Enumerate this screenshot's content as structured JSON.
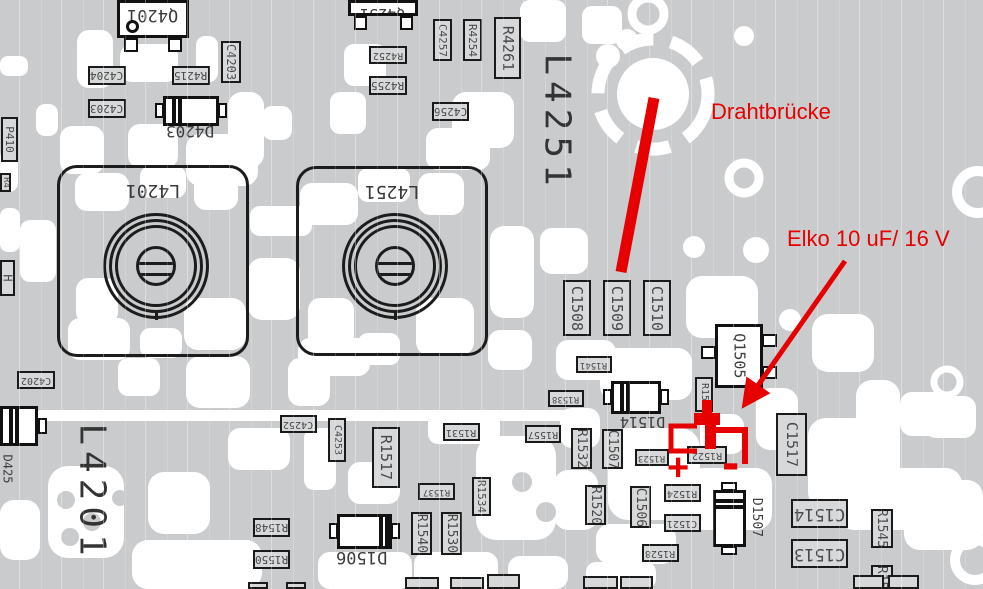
{
  "colors": {
    "board_bg": "#c9cbcd",
    "trace_white": "#ffffff",
    "component_fill": "#d7d8d9",
    "component_border": "#1a1a1a",
    "label_text": "#484848",
    "big_text": "#333333",
    "annotation_red": "#e60000"
  },
  "annotations": {
    "wire_bridge": {
      "text": "Drahtbrücke",
      "x": 711,
      "y": 99
    },
    "elko": {
      "text": "Elko 10 uF/ 16 V",
      "x": 787,
      "y": 226
    },
    "plus_sign": "+",
    "minus_sign": "-"
  },
  "big_texts": [
    {
      "text": "L4251",
      "x": 535,
      "y": 42,
      "w": 44,
      "h": 160,
      "fs": 36
    },
    {
      "text": "L4201",
      "x": 70,
      "y": 414,
      "w": 44,
      "h": 156,
      "fs": 36
    }
  ],
  "coils": [
    {
      "label": "L4201",
      "x": 57,
      "y": 165,
      "w": 192,
      "h": 192
    },
    {
      "label": "L4251",
      "x": 296,
      "y": 166,
      "w": 192,
      "h": 190
    }
  ],
  "transistors": [
    {
      "label": "Q4201",
      "x": 117,
      "y": 0,
      "w": 72,
      "h": 38,
      "rot": 180,
      "fs": 17,
      "legs": [
        [
          124,
          38,
          14,
          14
        ],
        [
          168,
          38,
          14,
          14
        ]
      ],
      "dot": [
        126,
        20,
        13
      ]
    },
    {
      "label": "Q4251",
      "x": 348,
      "y": 0,
      "w": 70,
      "h": 16,
      "rot": 180,
      "fs": 15,
      "legs": [
        [
          354,
          16,
          13,
          14
        ],
        [
          400,
          16,
          13,
          14
        ]
      ]
    },
    {
      "label": "Q1505",
      "x": 715,
      "y": 324,
      "w": 48,
      "h": 64,
      "rot": 90,
      "fs": 15,
      "legs": [
        [
          701,
          346,
          15,
          13
        ],
        [
          762,
          334,
          15,
          13
        ],
        [
          762,
          366,
          15,
          13
        ]
      ]
    }
  ],
  "diodes": [
    {
      "label": "D4203",
      "x": 163,
      "y": 96,
      "w": 56,
      "h": 30,
      "stripes": "left",
      "tabs": [
        [
          155,
          103,
          9,
          15
        ],
        [
          218,
          103,
          9,
          15
        ]
      ],
      "label_box": [
        158,
        121,
        64,
        20
      ],
      "rot": 180,
      "fs": 16
    },
    {
      "label": "D1514",
      "x": 611,
      "y": 381,
      "w": 50,
      "h": 33,
      "stripes": "left",
      "tabs": [
        [
          603,
          389,
          9,
          16
        ],
        [
          660,
          389,
          9,
          16
        ]
      ],
      "label_box": [
        615,
        412,
        56,
        18
      ],
      "rot": 180,
      "fs": 15
    },
    {
      "label": "D1506",
      "x": 337,
      "y": 514,
      "w": 55,
      "h": 35,
      "stripes": "right",
      "tabs": [
        [
          329,
          523,
          9,
          16
        ],
        [
          391,
          523,
          9,
          16
        ]
      ],
      "label_box": [
        330,
        545,
        64,
        22
      ],
      "rot": 180,
      "fs": 17
    },
    {
      "label": "D1507",
      "x": 713,
      "y": 490,
      "w": 33,
      "h": 57,
      "stripes": "top",
      "tabs": [
        [
          721,
          482,
          16,
          9
        ],
        [
          721,
          546,
          16,
          9
        ]
      ],
      "label_box": [
        748,
        486,
        17,
        62
      ],
      "rot": 90,
      "fs": 13
    },
    {
      "label": "D425",
      "x": 0,
      "y": 406,
      "w": 38,
      "h": 40,
      "stripes": "left",
      "tabs": [
        [
          38,
          418,
          9,
          16
        ]
      ],
      "label_box": [
        0,
        446,
        15,
        46
      ],
      "rot": 90,
      "fs": 12
    }
  ],
  "chips": [
    {
      "label": "C4204",
      "x": 88,
      "y": 66,
      "w": 38,
      "h": 19,
      "rot": 180
    },
    {
      "label": "R4215",
      "x": 172,
      "y": 66,
      "w": 38,
      "h": 19,
      "rot": 180
    },
    {
      "label": "C4203",
      "x": 221,
      "y": 41,
      "w": 20,
      "h": 42,
      "rot": 90
    },
    {
      "label": "C4203",
      "x": 88,
      "y": 99,
      "w": 38,
      "h": 19,
      "rot": 180
    },
    {
      "label": "R4252",
      "x": 369,
      "y": 46,
      "w": 38,
      "h": 18,
      "rot": 180
    },
    {
      "label": "R4255",
      "x": 369,
      "y": 76,
      "w": 38,
      "h": 19,
      "rot": 180
    },
    {
      "label": "C4256",
      "x": 432,
      "y": 102,
      "w": 37,
      "h": 19,
      "rot": 180
    },
    {
      "label": "C4257",
      "x": 433,
      "y": 19,
      "w": 19,
      "h": 42,
      "rot": 90
    },
    {
      "label": "R4254",
      "x": 463,
      "y": 19,
      "w": 19,
      "h": 42,
      "rot": 90
    },
    {
      "label": "R4261",
      "x": 494,
      "y": 17,
      "w": 27,
      "h": 62,
      "rot": 90,
      "fs": 15
    },
    {
      "label": "C4202",
      "x": 17,
      "y": 371,
      "w": 38,
      "h": 18,
      "rot": 180
    },
    {
      "label": "C4252",
      "x": 280,
      "y": 415,
      "w": 37,
      "h": 18,
      "rot": 180
    },
    {
      "label": "C4253",
      "x": 328,
      "y": 418,
      "w": 18,
      "h": 44,
      "rot": 90
    },
    {
      "label": "C1508",
      "x": 563,
      "y": 280,
      "w": 28,
      "h": 56,
      "rot": 90,
      "fs": 15
    },
    {
      "label": "C1509",
      "x": 603,
      "y": 280,
      "w": 28,
      "h": 56,
      "rot": 90,
      "fs": 15
    },
    {
      "label": "C1510",
      "x": 643,
      "y": 280,
      "w": 28,
      "h": 56,
      "rot": 90,
      "fs": 15
    },
    {
      "label": "R1541",
      "x": 576,
      "y": 356,
      "w": 36,
      "h": 17,
      "rot": 180
    },
    {
      "label": "R1538",
      "x": 548,
      "y": 390,
      "w": 36,
      "h": 17,
      "rot": 180
    },
    {
      "label": "R1557",
      "x": 525,
      "y": 425,
      "w": 36,
      "h": 18,
      "rot": 180
    },
    {
      "label": "R1532",
      "x": 571,
      "y": 428,
      "w": 21,
      "h": 41,
      "rot": 90
    },
    {
      "label": "C1507",
      "x": 602,
      "y": 429,
      "w": 21,
      "h": 40,
      "rot": 90
    },
    {
      "label": "R1523",
      "x": 635,
      "y": 449,
      "w": 34,
      "h": 17,
      "rot": 180
    },
    {
      "label": "R1522",
      "x": 687,
      "y": 446,
      "w": 40,
      "h": 18,
      "rot": 180
    },
    {
      "label": "R154",
      "x": 695,
      "y": 377,
      "w": 18,
      "h": 35,
      "rot": 90
    },
    {
      "label": "R1520",
      "x": 585,
      "y": 485,
      "w": 21,
      "h": 40,
      "rot": 90
    },
    {
      "label": "C1506",
      "x": 630,
      "y": 486,
      "w": 21,
      "h": 42,
      "rot": 90
    },
    {
      "label": "R1524",
      "x": 664,
      "y": 484,
      "w": 37,
      "h": 18,
      "rot": 180
    },
    {
      "label": "C1521",
      "x": 664,
      "y": 514,
      "w": 37,
      "h": 18,
      "rot": 180
    },
    {
      "label": "R1528",
      "x": 642,
      "y": 544,
      "w": 37,
      "h": 18,
      "rot": 180
    },
    {
      "label": "C1517",
      "x": 776,
      "y": 413,
      "w": 31,
      "h": 63,
      "rot": 90,
      "fs": 15
    },
    {
      "label": "C1514",
      "x": 791,
      "y": 499,
      "w": 57,
      "h": 29,
      "rot": 180,
      "fs": 17
    },
    {
      "label": "C1513",
      "x": 791,
      "y": 539,
      "w": 57,
      "h": 29,
      "rot": 180,
      "fs": 17
    },
    {
      "label": "R1545",
      "x": 871,
      "y": 509,
      "w": 22,
      "h": 39,
      "rot": 90
    },
    {
      "label": "R15",
      "x": 871,
      "y": 565,
      "w": 22,
      "h": 24,
      "rot": 90
    },
    {
      "label": "R1548",
      "x": 253,
      "y": 518,
      "w": 37,
      "h": 19,
      "rot": 180
    },
    {
      "label": "R1550",
      "x": 253,
      "y": 550,
      "w": 37,
      "h": 19,
      "rot": 180
    },
    {
      "label": "R1531",
      "x": 443,
      "y": 423,
      "w": 37,
      "h": 18,
      "rot": 180
    },
    {
      "label": "R1537",
      "x": 418,
      "y": 483,
      "w": 37,
      "h": 17,
      "rot": 180
    },
    {
      "label": "R1534",
      "x": 472,
      "y": 477,
      "w": 19,
      "h": 39,
      "rot": 90
    },
    {
      "label": "R1540",
      "x": 411,
      "y": 512,
      "w": 21,
      "h": 43,
      "rot": 90
    },
    {
      "label": "R1530",
      "x": 441,
      "y": 512,
      "w": 21,
      "h": 43,
      "rot": 90
    },
    {
      "label": "R1517",
      "x": 372,
      "y": 427,
      "w": 28,
      "h": 61,
      "rot": 90,
      "fs": 15
    },
    {
      "label": "P410",
      "x": 1,
      "y": 117,
      "w": 17,
      "h": 45,
      "rot": 90,
      "fs": 11
    },
    {
      "label": "R4",
      "x": 0,
      "y": 173,
      "w": 11,
      "h": 19,
      "rot": 90,
      "fs": 9
    },
    {
      "label": "H",
      "x": 0,
      "y": 260,
      "w": 15,
      "h": 36,
      "rot": 90,
      "fs": 12
    },
    {
      "label": "",
      "x": 248,
      "y": 582,
      "w": 20,
      "h": 7,
      "rot": 0
    },
    {
      "label": "",
      "x": 286,
      "y": 582,
      "w": 20,
      "h": 7,
      "rot": 0
    },
    {
      "label": "",
      "x": 405,
      "y": 577,
      "w": 34,
      "h": 12,
      "rot": 0
    },
    {
      "label": "",
      "x": 450,
      "y": 577,
      "w": 34,
      "h": 12,
      "rot": 0
    },
    {
      "label": "",
      "x": 487,
      "y": 574,
      "w": 33,
      "h": 15,
      "rot": 0
    },
    {
      "label": "",
      "x": 583,
      "y": 576,
      "w": 35,
      "h": 13,
      "rot": 0
    },
    {
      "label": "",
      "x": 620,
      "y": 576,
      "w": 33,
      "h": 13,
      "rot": 0
    },
    {
      "label": "",
      "x": 853,
      "y": 575,
      "w": 31,
      "h": 14,
      "rot": 0
    },
    {
      "label": "",
      "x": 888,
      "y": 575,
      "w": 31,
      "h": 14,
      "rot": 0
    }
  ]
}
